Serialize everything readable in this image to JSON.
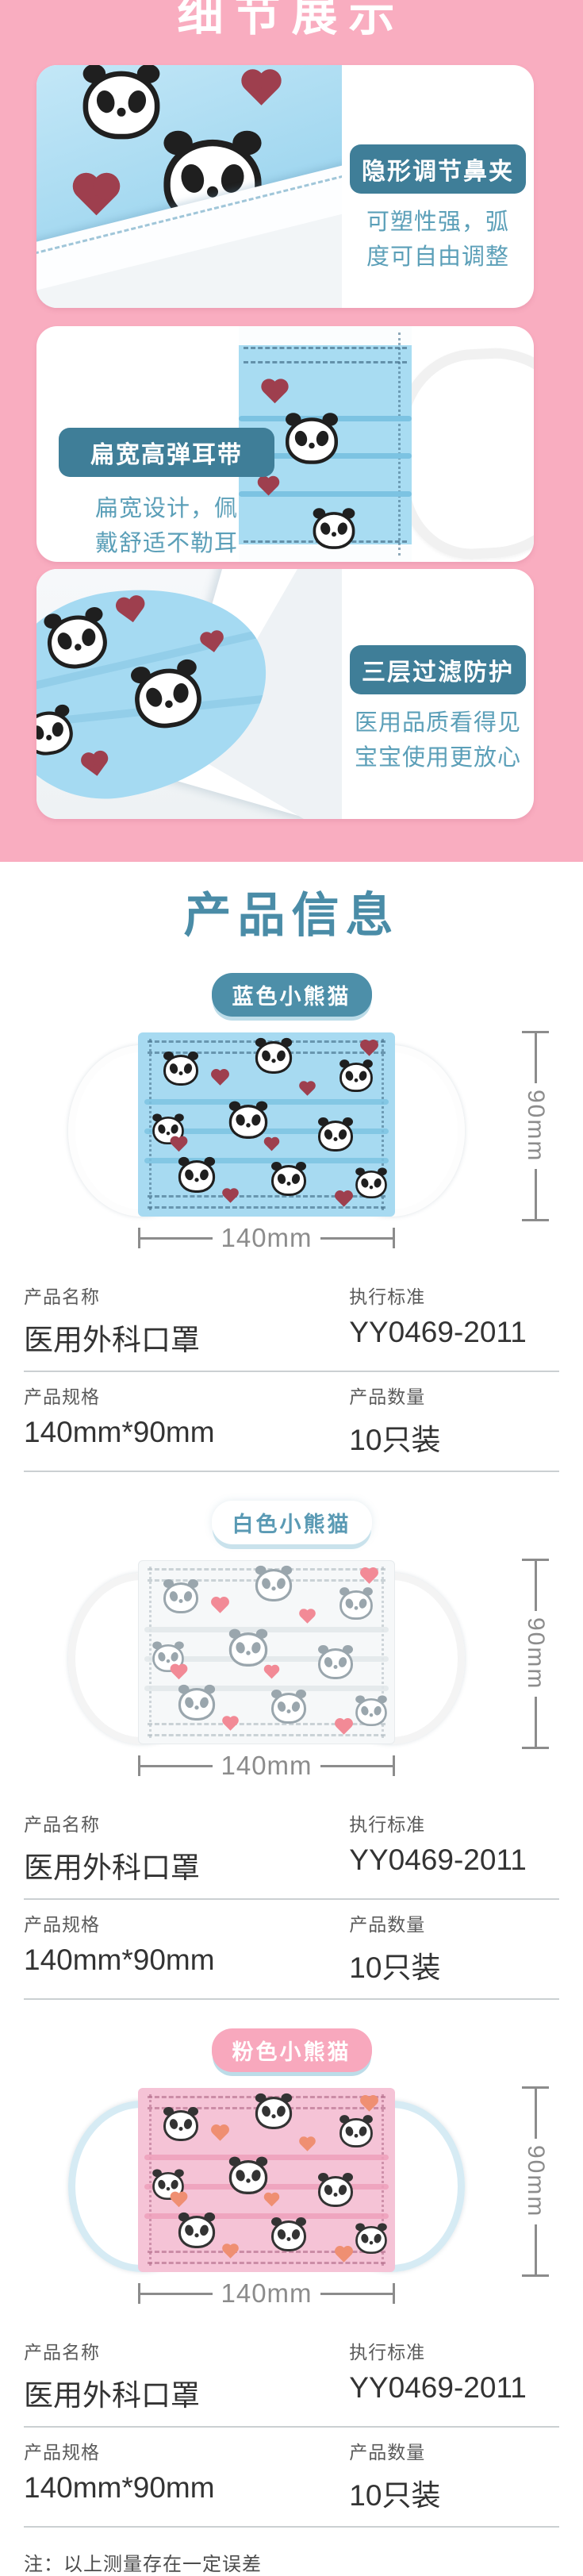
{
  "page": {
    "detail_title": "细节展示",
    "product_info_title": "产品信息",
    "note": "注：以上测量存在一定误差"
  },
  "colors": {
    "pink_background": "#f9adc0",
    "feature_badge_teal": "#3f7e98",
    "feature_text_teal": "#5b9fb8",
    "info_title_teal": "#4a8ca7",
    "dimension_gray": "#8c8c8c"
  },
  "detail_cards": [
    {
      "badge": "隐形调节鼻夹",
      "desc": [
        "可塑性强，弧",
        "度可自由调整"
      ]
    },
    {
      "badge": "扁宽高弹耳带",
      "desc": [
        "扁宽设计，佩",
        "戴舒适不勒耳"
      ]
    },
    {
      "badge": "三层过滤防护",
      "desc": [
        "医用品质看得见",
        "宝宝使用更放心"
      ]
    }
  ],
  "variants": [
    {
      "name": "蓝色小熊猫",
      "height_label": "90mm",
      "width_label": "140mm",
      "table": {
        "name_label": "产品名称",
        "name_value": "医用外科口罩",
        "std_label": "执行标准",
        "std_value": "YY0469-2011",
        "spec_label": "产品规格",
        "spec_value": "140mm*90mm",
        "qty_label": "产品数量",
        "qty_value": "10只装"
      }
    },
    {
      "name": "白色小熊猫",
      "height_label": "90mm",
      "width_label": "140mm",
      "table": {
        "name_label": "产品名称",
        "name_value": "医用外科口罩",
        "std_label": "执行标准",
        "std_value": "YY0469-2011",
        "spec_label": "产品规格",
        "spec_value": "140mm*90mm",
        "qty_label": "产品数量",
        "qty_value": "10只装"
      }
    },
    {
      "name": "粉色小熊猫",
      "height_label": "90mm",
      "width_label": "140mm",
      "table": {
        "name_label": "产品名称",
        "name_value": "医用外科口罩",
        "std_label": "执行标准",
        "std_value": "YY0469-2011",
        "spec_label": "产品规格",
        "spec_value": "140mm*90mm",
        "qty_label": "产品数量",
        "qty_value": "10只装"
      }
    }
  ]
}
